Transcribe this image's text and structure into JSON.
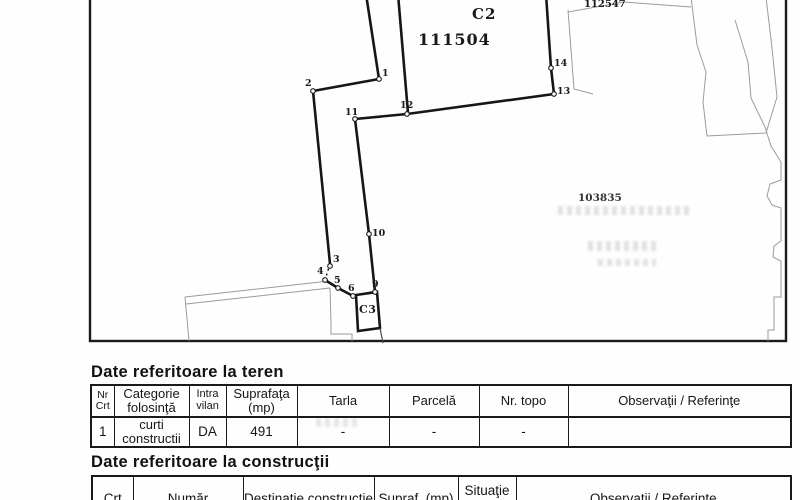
{
  "map": {
    "building_c2_label": "C2",
    "parcel_number": "111504",
    "neighbor_parcel_top": "112547",
    "neighbor_parcel_right": "103835",
    "building_c3_label": "C3",
    "boundary_points": [
      "1",
      "2",
      "3",
      "4",
      "5",
      "6",
      "9",
      "10",
      "11",
      "12",
      "13",
      "14"
    ]
  },
  "land_table": {
    "heading": "Date referitoare la teren",
    "columns": [
      "Nr Crt",
      "Categorie folosinţă",
      "Intra vilan",
      "Suprafaţa (mp)",
      "Tarla",
      "Parcelă",
      "Nr. topo",
      "Observaţii / Referinţe"
    ],
    "rows": [
      {
        "nr_crt": "1",
        "categorie": "curti constructii",
        "intravilan": "DA",
        "suprafata": "491",
        "tarla": "-",
        "parcela": "-",
        "nr_topo": "-",
        "observatii": ""
      }
    ]
  },
  "constructions_table": {
    "heading": "Date referitoare la construcţii",
    "columns": [
      "Crt",
      "Număr",
      "Destinaţie construcţie",
      "Supraf. (mp)",
      "Situaţie juridică",
      "Observaţii / Referinţe"
    ]
  }
}
